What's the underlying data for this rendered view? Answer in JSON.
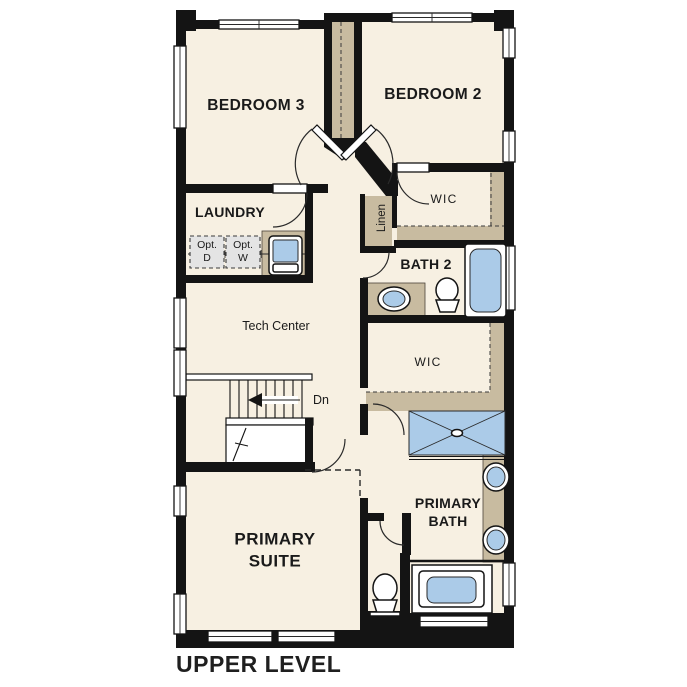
{
  "title": "UPPER LEVEL",
  "rooms": {
    "bedroom3": "BEDROOM 3",
    "bedroom2": "BEDROOM 2",
    "laundry": "LAUNDRY",
    "wic_upper": "WIC",
    "wic_lower": "WIC",
    "bath2": "BATH 2",
    "linen": "Linen",
    "tech_center": "Tech Center",
    "primary_bath": {
      "line1": "PRIMARY",
      "line2": "BATH"
    },
    "primary_suite": {
      "line1": "PRIMARY",
      "line2": "SUITE"
    }
  },
  "annotations": {
    "stairs_direction": "Dn",
    "opt_dryer": {
      "line1": "Opt.",
      "line2": "D"
    },
    "opt_washer": {
      "line1": "Opt.",
      "line2": "W"
    }
  },
  "colors": {
    "floor": "#f7f0e2",
    "casework_tan": "#c8bba0",
    "fixture_blue": "#abcbe8",
    "wall_black": "#141414",
    "optional_appliance_gray": "#e4e4e4",
    "background": "#ffffff"
  }
}
